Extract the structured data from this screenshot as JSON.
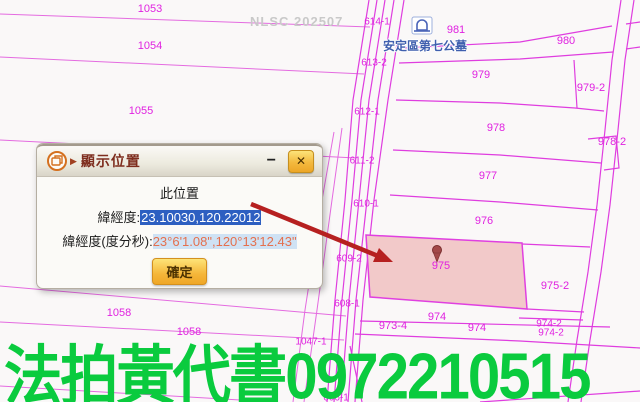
{
  "map": {
    "watermark": "NLSC 202507",
    "poi_label": "安定區第七公墓",
    "highlighted_parcel": "975",
    "colors": {
      "parcel_line": "#df3ddf",
      "parcel_label": "#e022e0",
      "highlight_fill": "#f2c9c9",
      "arrow": "#b62020",
      "poi_text": "#3f5fae"
    },
    "parcel_labels": [
      {
        "text": "1053",
        "x": 150,
        "y": 9
      },
      {
        "text": "1054",
        "x": 150,
        "y": 46
      },
      {
        "text": "1055",
        "x": 141,
        "y": 111
      },
      {
        "text": "1058",
        "x": 119,
        "y": 313
      },
      {
        "text": "1058",
        "x": 189,
        "y": 332
      },
      {
        "text": "1047-1",
        "x": 311,
        "y": 342,
        "s": 1
      },
      {
        "text": "606-1",
        "x": 336,
        "y": 398,
        "s": 1
      },
      {
        "text": "614-1",
        "x": 377,
        "y": 22,
        "s": 1
      },
      {
        "text": "613-2",
        "x": 374,
        "y": 63,
        "s": 1
      },
      {
        "text": "612-1",
        "x": 367,
        "y": 112,
        "s": 1
      },
      {
        "text": "611-2",
        "x": 362,
        "y": 161,
        "s": 1
      },
      {
        "text": "610-1",
        "x": 366,
        "y": 204,
        "s": 1
      },
      {
        "text": "609-2",
        "x": 349,
        "y": 259,
        "s": 1
      },
      {
        "text": "608-1",
        "x": 347,
        "y": 304,
        "s": 1
      },
      {
        "text": "981",
        "x": 456,
        "y": 30
      },
      {
        "text": "980",
        "x": 566,
        "y": 41
      },
      {
        "text": "979",
        "x": 481,
        "y": 75
      },
      {
        "text": "979-2",
        "x": 591,
        "y": 88
      },
      {
        "text": "978",
        "x": 496,
        "y": 128
      },
      {
        "text": "978-2",
        "x": 612,
        "y": 142
      },
      {
        "text": "977",
        "x": 488,
        "y": 176
      },
      {
        "text": "976",
        "x": 484,
        "y": 221
      },
      {
        "text": "975",
        "x": 441,
        "y": 266
      },
      {
        "text": "975-2",
        "x": 555,
        "y": 286
      },
      {
        "text": "974",
        "x": 437,
        "y": 317
      },
      {
        "text": "973-4",
        "x": 393,
        "y": 326
      },
      {
        "text": "974",
        "x": 477,
        "y": 328
      },
      {
        "text": "974-2",
        "x": 549,
        "y": 324,
        "s": 1
      },
      {
        "text": "974-2",
        "x": 551,
        "y": 333,
        "s": 1
      }
    ]
  },
  "dialog": {
    "title": "顯示位置",
    "minimize_label": "−",
    "close_label": "✕",
    "location_heading": "此位置",
    "latlng_label": "緯經度:",
    "latlng_value": "23.10030,120.22012",
    "dms_label": "緯經度(度分秒):",
    "dms_value": "23°6'1.08\",120°13'12.43\"",
    "confirm_label": "確定"
  },
  "ad_overlay": {
    "text": "法拍黃代書0972210515",
    "color": "#0acb3e"
  }
}
